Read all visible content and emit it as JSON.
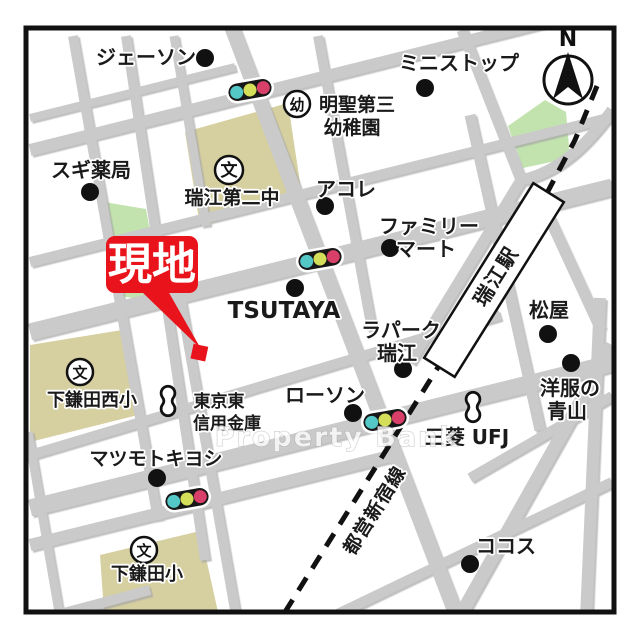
{
  "map": {
    "site_marker_label": "現地",
    "compass_label": "N",
    "watermark_text": "Property Bank",
    "station_label": "瑞江駅",
    "railway_label": "都営新宿線",
    "school_icon_glyph": "文",
    "kindergarten_icon_glyph": "幼",
    "labels": {
      "jason": "ジェーソン",
      "ministop": "ミニストップ",
      "meisei_1": "明聖第三",
      "meisei_2": "幼稚園",
      "sugi": "スギ薬局",
      "mizue_dai2": "瑞江第二中",
      "acole": "アコレ",
      "famima_1": "ファミリー",
      "famima_2": "マート",
      "tsutaya": "TSUTAYA",
      "matsuya": "松屋",
      "lapark_1": "ラパーク",
      "lapark_2": "瑞江",
      "aoyama_1": "洋服の",
      "aoyama_2": "青山",
      "shimokamata_nishi": "下鎌田西小",
      "tokyo_higashi_1": "東京東",
      "tokyo_higashi_2": "信用金庫",
      "lawson": "ローソン",
      "mitsubishi_ufj": "三菱 UFJ",
      "matsumoto_kiyoshi": "マツモトキヨシ",
      "cocos": "ココス",
      "shimokamata": "下鎌田小"
    },
    "colors": {
      "site_red": "#E8131B",
      "school_block": "#D6CFA0",
      "park_green": "#C2E3AE",
      "signal_teal": "#54C7C7",
      "signal_yellow": "#D5DE58",
      "signal_red": "#D8406A",
      "signal_body": "#171717"
    }
  }
}
